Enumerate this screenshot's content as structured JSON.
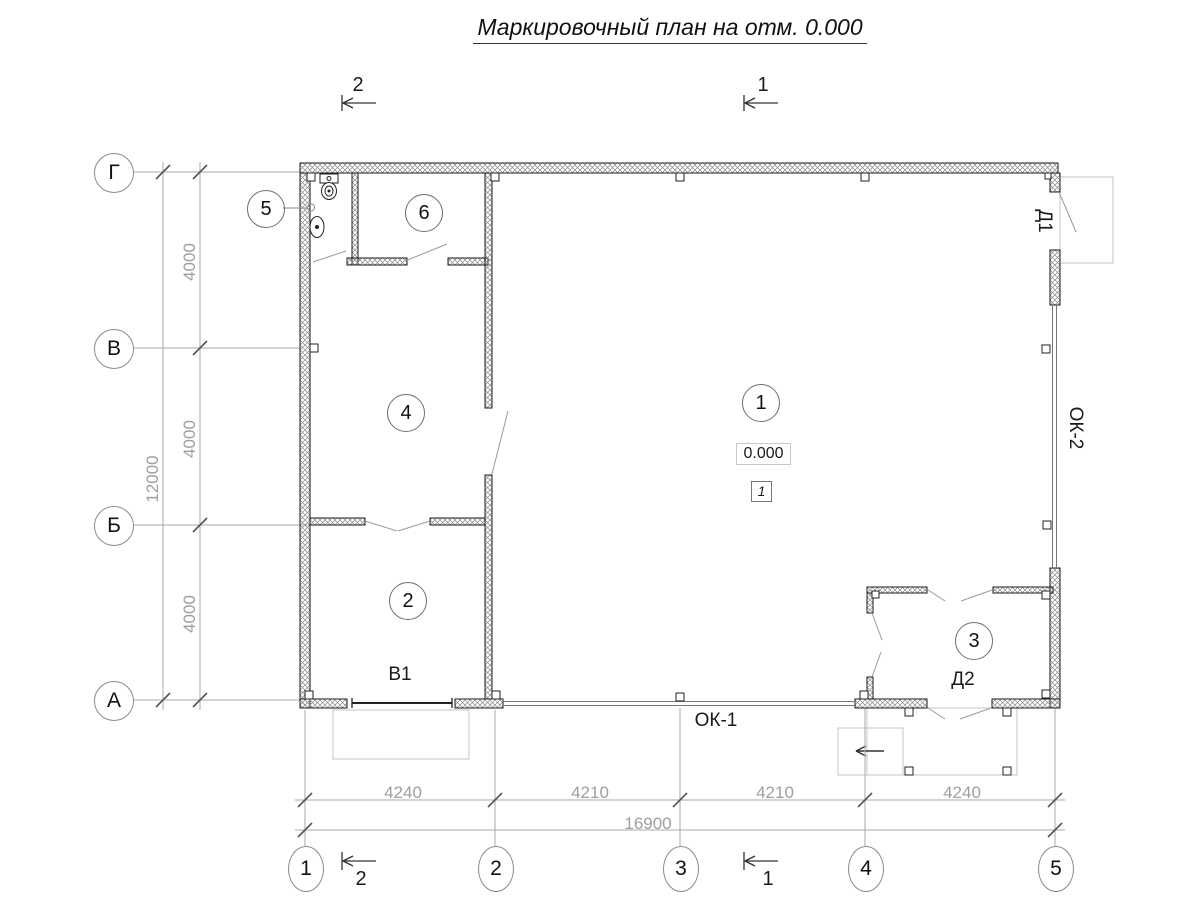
{
  "title": "Маркировочный план на отм. 0.000",
  "markers": {
    "top_left": "2",
    "top_right": "1",
    "bottom_left": "2",
    "bottom_right": "1"
  },
  "axes_left": [
    "Г",
    "В",
    "Б",
    "А"
  ],
  "axes_bottom": [
    "1",
    "2",
    "3",
    "4",
    "5"
  ],
  "dims_left": {
    "segments": [
      "4000",
      "4000",
      "4000"
    ],
    "total": "12000"
  },
  "dims_bottom": {
    "segments": [
      "4240",
      "4210",
      "4210",
      "4240"
    ],
    "total": "16900"
  },
  "rooms": [
    "1",
    "2",
    "3",
    "4",
    "5",
    "6"
  ],
  "marks": {
    "elevation": "0.000",
    "zone": "1",
    "gate": "В1",
    "window_bottom": "ОК-1",
    "window_right": "ОК-2",
    "door_right": "Д1",
    "door_bottom": "Д2"
  },
  "colors": {
    "line_dark": "#1a1a1a",
    "dimension_gray": "#9e9e9e",
    "light_gray": "#c4c4c4",
    "wall_hatch": "#8a8a8a",
    "background": "#ffffff"
  }
}
